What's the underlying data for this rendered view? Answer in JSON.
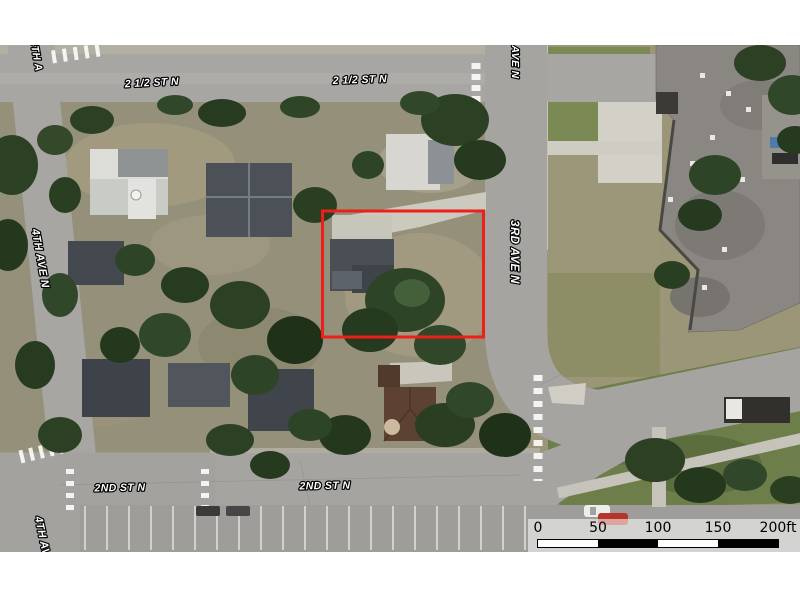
{
  "map": {
    "street_labels": [
      {
        "id": "two-half-st-n-west",
        "text": "2 1/2 ST N"
      },
      {
        "id": "two-half-st-n-east",
        "text": "2 1/2 ST N"
      },
      {
        "id": "ave-n-top",
        "text": "AVE N"
      },
      {
        "id": "fourth-ave-top",
        "text": "4TH A"
      },
      {
        "id": "fourth-ave-n",
        "text": "4TH AVE N"
      },
      {
        "id": "third-ave-n",
        "text": "3RD AVE N"
      },
      {
        "id": "second-st-n-west",
        "text": "2ND ST N"
      },
      {
        "id": "second-st-n-east",
        "text": "2ND ST N"
      },
      {
        "id": "fourth-av-bottom",
        "text": "4TH AV"
      }
    ],
    "parcel_outline_color": "#ee1f1a"
  },
  "scale_bar": {
    "ticks": [
      "0",
      "50",
      "100",
      "150",
      "200ft"
    ]
  }
}
